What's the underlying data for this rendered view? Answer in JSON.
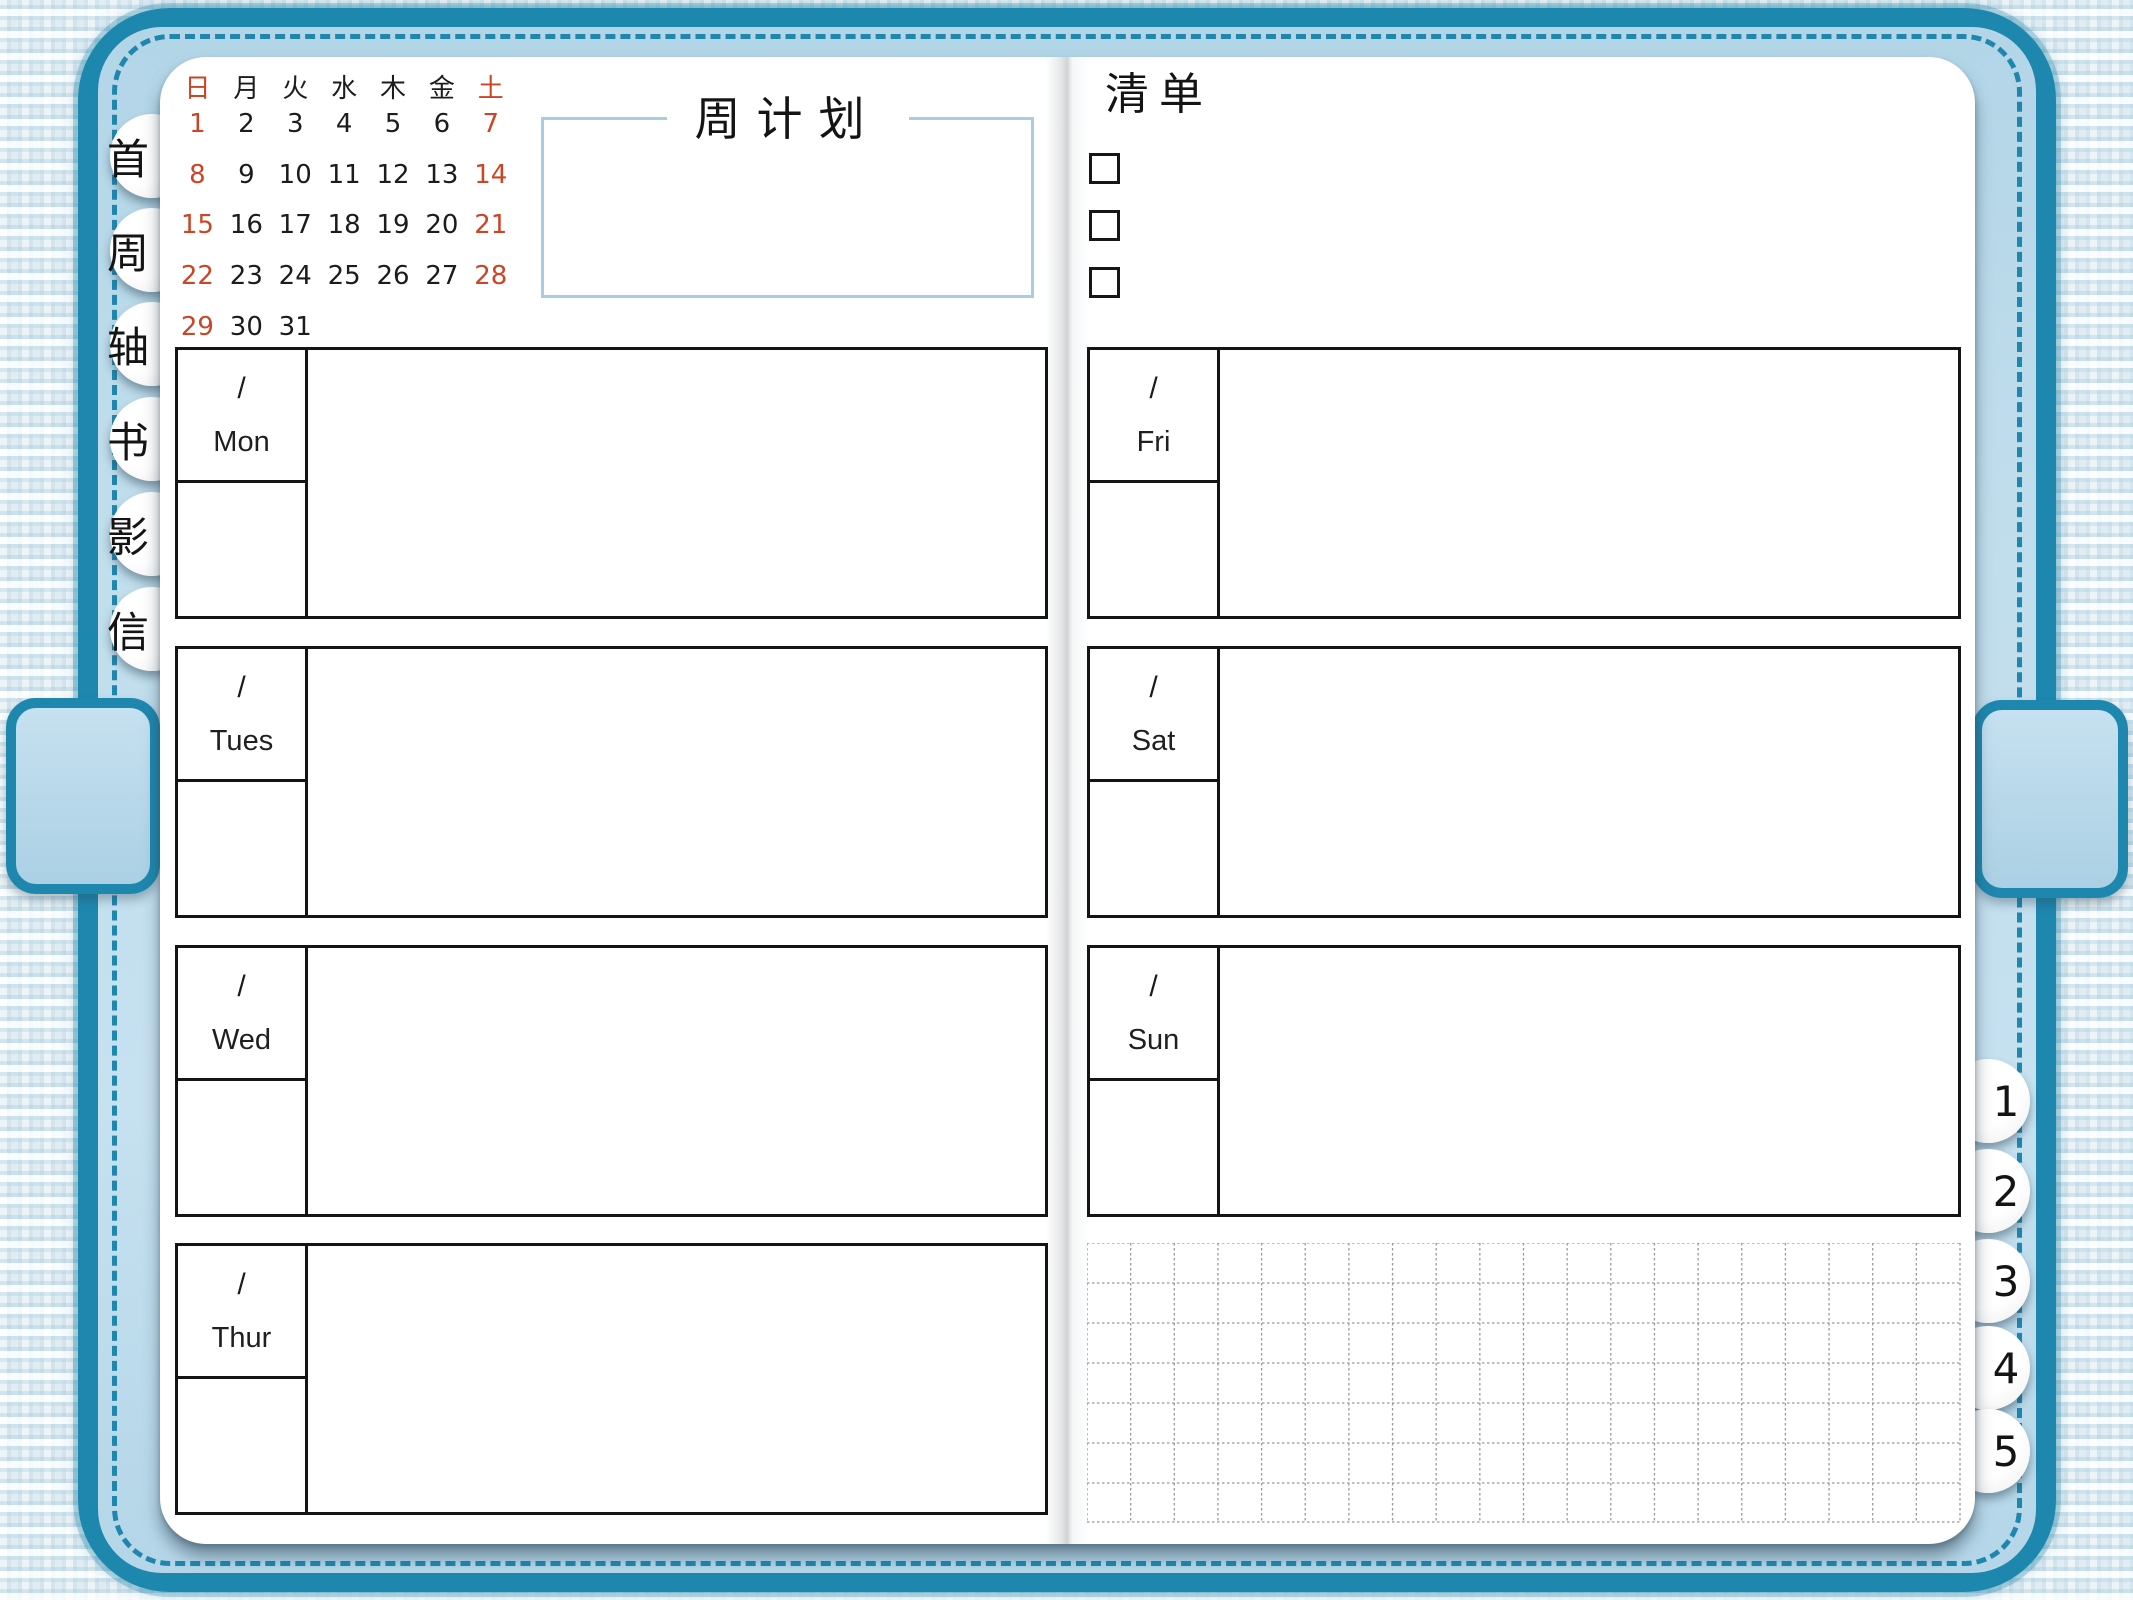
{
  "cover": {
    "accent_color": "#1e87ae",
    "band_color": "#bddcec",
    "weekend_color": "#cb4527"
  },
  "calendar": {
    "weekday_headers": [
      "日",
      "月",
      "火",
      "水",
      "木",
      "金",
      "土"
    ],
    "weekend_columns": [
      0,
      6
    ],
    "weeks": [
      [
        "1",
        "2",
        "3",
        "4",
        "5",
        "6",
        "7"
      ],
      [
        "8",
        "9",
        "10",
        "11",
        "12",
        "13",
        "14"
      ],
      [
        "15",
        "16",
        "17",
        "18",
        "19",
        "20",
        "21"
      ],
      [
        "22",
        "23",
        "24",
        "25",
        "26",
        "27",
        "28"
      ],
      [
        "29",
        "30",
        "31",
        "",
        "",
        "",
        ""
      ]
    ]
  },
  "left_page": {
    "title": "周计划",
    "day_boxes": [
      {
        "date_placeholder": "/",
        "label": "Mon"
      },
      {
        "date_placeholder": "/",
        "label": "Tues"
      },
      {
        "date_placeholder": "/",
        "label": "Wed"
      },
      {
        "date_placeholder": "/",
        "label": "Thur"
      }
    ]
  },
  "right_page": {
    "checklist": {
      "title": "清单",
      "items": [
        "",
        "",
        ""
      ]
    },
    "day_boxes": [
      {
        "date_placeholder": "/",
        "label": "Fri"
      },
      {
        "date_placeholder": "/",
        "label": "Sat"
      },
      {
        "date_placeholder": "/",
        "label": "Sun"
      }
    ]
  },
  "tabs": {
    "left": [
      "首",
      "周",
      "轴",
      "书",
      "影",
      "信"
    ],
    "right": [
      "1",
      "2",
      "3",
      "4",
      "5"
    ]
  }
}
